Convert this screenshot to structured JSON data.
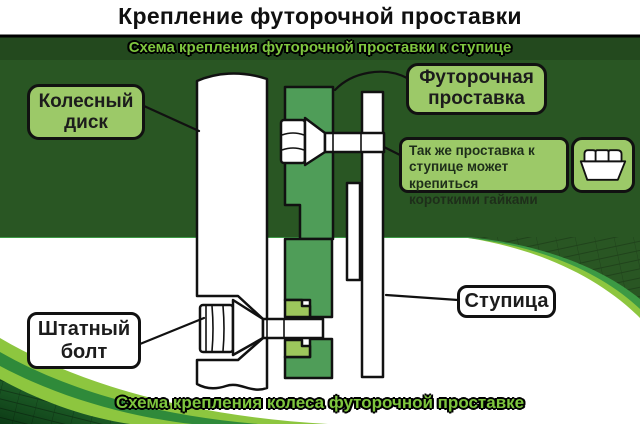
{
  "title": "Крепление футорочной проставки",
  "top_banner": "Схема крепления футорочной проставки к ступице",
  "bottom_banner": "Схема крепления колеса футорочной проставке",
  "labels": {
    "wheel_disk": "Колесный диск",
    "spacer": "Футорочная проставка",
    "stock_bolt": "Штатный болт",
    "hub": "Ступица"
  },
  "callout": {
    "line1": "Так же проставка к",
    "line2": "ступице может крепиться",
    "line3": "короткими гайками"
  },
  "icons": {
    "nut": "nut-icon"
  },
  "colors": {
    "panel_dark_green": "#295623",
    "label_green": "#9cc968",
    "spacer_green": "#4f9d58",
    "insert_green": "#9dc65c",
    "swoosh_light_green": "#8dc63f",
    "swoosh_mid_green": "#3c9a44",
    "banner_text_green": "#7ec63e",
    "outline_black": "#111111",
    "background_white": "#ffffff"
  }
}
